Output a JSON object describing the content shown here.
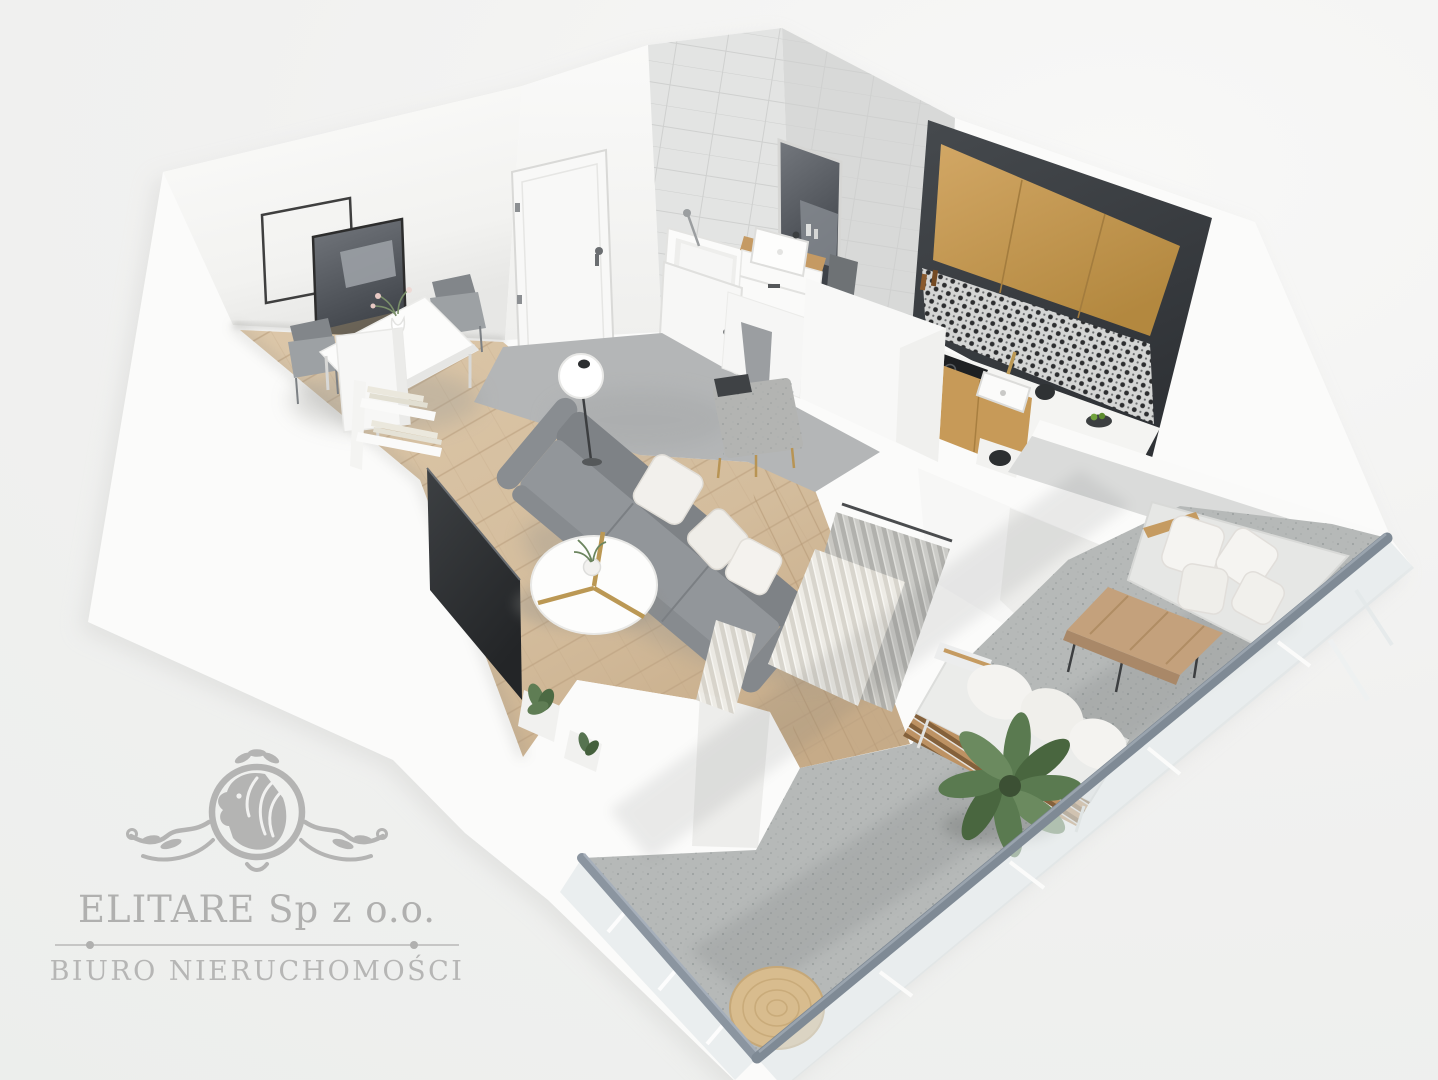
{
  "watermark": {
    "company": "ELITARE Sp z o.o.",
    "tagline": "BIURO NIERUCHOMOŚCI"
  },
  "palette": {
    "bg": "#f1f1f0",
    "wall": "#fbfbfa",
    "wall_shade": "#ebebe9",
    "tile": "#e0e1e0",
    "tile_dark": "#d4d5d4",
    "wood": "#d7c1a2",
    "wood_deep": "#c5aa87",
    "plank_line": "#bfa483",
    "hall_floor": "#b4b6b7",
    "concrete": "#b6b9b8",
    "charcoal": "#3b3e42",
    "oak": "#c89c5c",
    "tv_black": "#303336",
    "mirror": "#50545a",
    "sofa": "#8b8f93",
    "sofa_seat": "#989ca0",
    "pillow": "#f2f0ec",
    "ottoman": "#b3b4b2",
    "curtain": "#edebe4",
    "sheer": "#c6c6c2",
    "rail": "#7f8a95",
    "glass": "#dde4e6",
    "plant": "#5b7a51",
    "plant_dark": "#47633e",
    "jute": "#d8bc8e",
    "brass": "#bb9854",
    "logo": "#b0b0af"
  },
  "scene": {
    "type": "3d-floor-plan-render",
    "view": "axonometric top-down apartment visualization",
    "rooms": [
      "living room",
      "dining area",
      "entry hall",
      "bathroom",
      "kitchen",
      "balcony"
    ],
    "furniture": [
      "white dining table with flower vase",
      "two gray dining chairs and one white chair",
      "white bookshelf with books",
      "wall mirror and empty square frame",
      "white entry door",
      "bathtub with hand shower",
      "bathroom vanity with washbasin and wood top",
      "dark bathroom mirror and towel",
      "charcoal kitchen wall with oak upper cabinets",
      "patterned tile backsplash",
      "black cooktop, oven and sink with brass faucet",
      "gray three-seat sofa with three white cushions",
      "round white coffee table with brass legs and plant",
      "white globe floor lamp",
      "speckled gray ottoman bench with dark tray",
      "dark TV sideboard with potted plants",
      "sheer and cream pleated curtains",
      "outdoor lounge sofa with white cushions",
      "outdoor bench with wood slats",
      "wooden outdoor coffee table",
      "large potted green plant",
      "round jute rug",
      "glass balcony railing with slate handrail"
    ]
  }
}
